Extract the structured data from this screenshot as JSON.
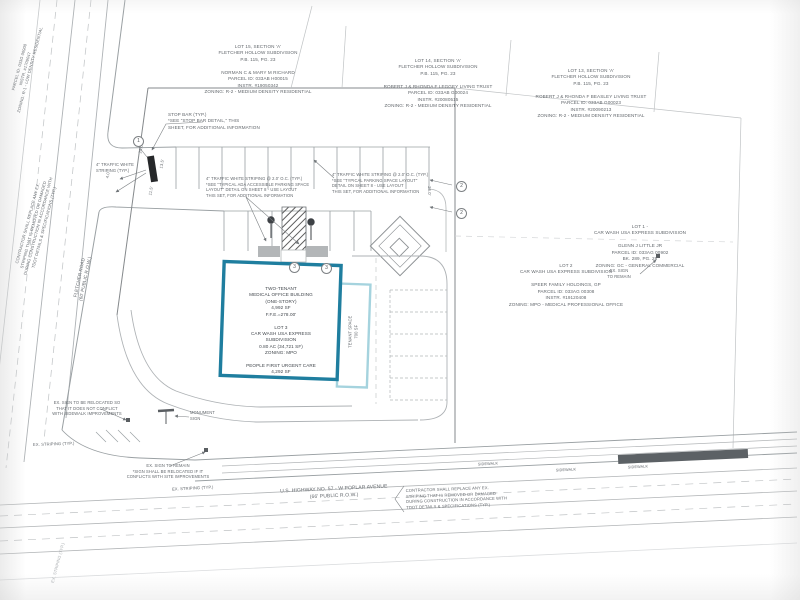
{
  "drawing": {
    "type": "civil-site-plan",
    "colors": {
      "building_outline": "#1f7e9f",
      "tenant_outline": "#a5d3de",
      "linework": "#9aa0a3",
      "text": "#62676c",
      "stop_bar": "#26282a",
      "asphalt_bar": "#5c6165"
    }
  },
  "adjacent_lots": {
    "lot15": "LOT 15, SECTION 'A'\nFLETCHER HOLLOW SUBDIVISION\nP.B. 115, PG. 23\n\nNORMAN C & MARY M RICHARD\nPARCEL ID: 033AB H00015\nINSTR. #19050342\nZONING: R-2 - MEDIUM DENSITY RESIDENTIAL",
    "lot14": "LOT 14, SECTION 'A'\nFLETCHER HOLLOW SUBDIVISION\nP.B. 115, PG. 23\n\nROBERT J & RHONDA F LEGGEY LIVING TRUST\nPARCEL ID: 033AB G00024\nINSTR. #20080515\nZONING: R-2 - MEDIUM DENSITY RESIDENTIAL",
    "lot13": "LOT 13, SECTION 'A'\nFLETCHER HOLLOW SUBDIVISION\nP.B. 115, PG. 23\n\nROBERT J & RHONDA F BEASLEY LIVING TRUST\nPARCEL ID: 033AB G00023\nINSTR. #20090213\nZONING: R-2 - MEDIUM DENSITY RESIDENTIAL",
    "lot1": "LOT 1 -\nCAR WASH USA EXPRESS SUBDIVISION\n\nGLENN J LITTLE JR\nPARCEL ID: 033AG 00902\nBK. 289, PG. 28\nZONING: GC - GENERAL COMMERCIAL",
    "lot2": "LOT 2\nCAR WASH USA EXPRESS SUBDIVISION\n\nSPEER FAMILY HOLDINGS, GP\nPARCEL ID: 033AG 00308\nINSTR. #19120408\nZONING: MPO - MEDICAL PROFESSIONAL OFFICE",
    "corner_parcel": "PARCEL ID: 033G 00900\nINSTR. #1709047\nZONING: R-1 - LOW DENSITY RESIDENTIAL"
  },
  "site": {
    "building_label": "TWO-TENANT\nMEDICAL OFFICE BUILDING\n(ONE-STORY)\n4,992 SF\nF.F.E.=278.00'\n\nLOT 3\nCAR WASH USA EXPRESS\nSUBDIVISION\n0.80 AC (34,721 SF)\nZONING: MPO\n\nPEOPLE FIRST URGENT CARE\n4,292 SF",
    "tenant_space": "TENANT SPACE\n700 SF"
  },
  "roads": {
    "fletcher": {
      "label": "FLETCHER ROAD\n(60' PUBLIC R.O.W.)"
    },
    "highway": {
      "label": "U.S. HIGHWAY NO. 57 - W POPLAR AVENUE\n(66' PUBLIC R.O.W.)"
    },
    "sidewalk_labels": [
      "SIDEWALK",
      "SIDEWALK",
      "SIDEWALK"
    ]
  },
  "notes": {
    "stop_bar": "STOP BAR (TYP.)\n*SEE \"STOP BAR DETAIL,\" THIS\nSHEET, FOR ADDITIONAL INFORMATION",
    "ada_striping": "4\" TRAFFIC WHITE STRIPING @ 2.0' O.C. (TYP.)\n*SEE \"TYPICAL ADA ACCESSIBLE PARKING SPACE\nLAYOUT\" DETAIL ON SHEET 8 - USE LAYOUT\nTHIS SET, FOR ADDITIONAL INFORMATION",
    "parking_striping": "4\" TRAFFIC WHITE STRIPING @ 2.0' O.C. (TYP.)\n*SEE \"TYPICAL PARKING SPACE LAYOUT\"\nDETAIL ON SHEET 8 - USE LAYOUT\nTHIS SET, FOR ADDITIONAL INFORMATION",
    "white_striping": "4\" TRAFFIC WHITE\nSTRIPING (TYP.)",
    "contractor_left": "CONTRACTOR SHALL REPLACE ANY EX.\nSTRIPING THAT IS REMOVED OR DAMAGED\nDURING CONSTRUCTION IN ACCORDANCE WITH\nTDOT DETAILS & SPECIFICATIONS (TYP.)",
    "contractor_bottom": "CONTRACTOR SHALL REPLACE ANY EX.\nSTRIPING THAT IS REMOVED OR DAMAGED\nDURING CONSTRUCTION IN ACCORDANCE WITH\nTDOT DETAILS & SPECIFICATIONS (TYP.)",
    "ex_striping_1": "EX. STRIPING (TYP.)",
    "ex_striping_2": "EX. STRIPING (TYP.)",
    "ex_striping_3": "EX. STRIPING (TYP.)",
    "monument_sign": "MONUMENT\nSIGN",
    "ex_sign_relocate": "EX. SIGN TO BE RELOCATED SO\nTHAT IT DOES NOT CONFLICT\nWITH SIDEWALK IMPROVEMENTS",
    "ex_sign_remain_bottom": "EX. SIGN TO REMAIN\n*SIGN SHALL BE RELOCATED IF IT\nCONFLICTS WITH SITE IMPROVEMENTS",
    "ex_sign_remain_right": "EX. SIGN\nTO REMAIN"
  },
  "dimensions": {
    "d1": "24.0'",
    "d2": "13.5'",
    "d3": "11.5'",
    "d4": "4.0'",
    "d5": "26.0'"
  },
  "keynotes": {
    "k1": "1",
    "k2": "2",
    "k3": "3"
  }
}
